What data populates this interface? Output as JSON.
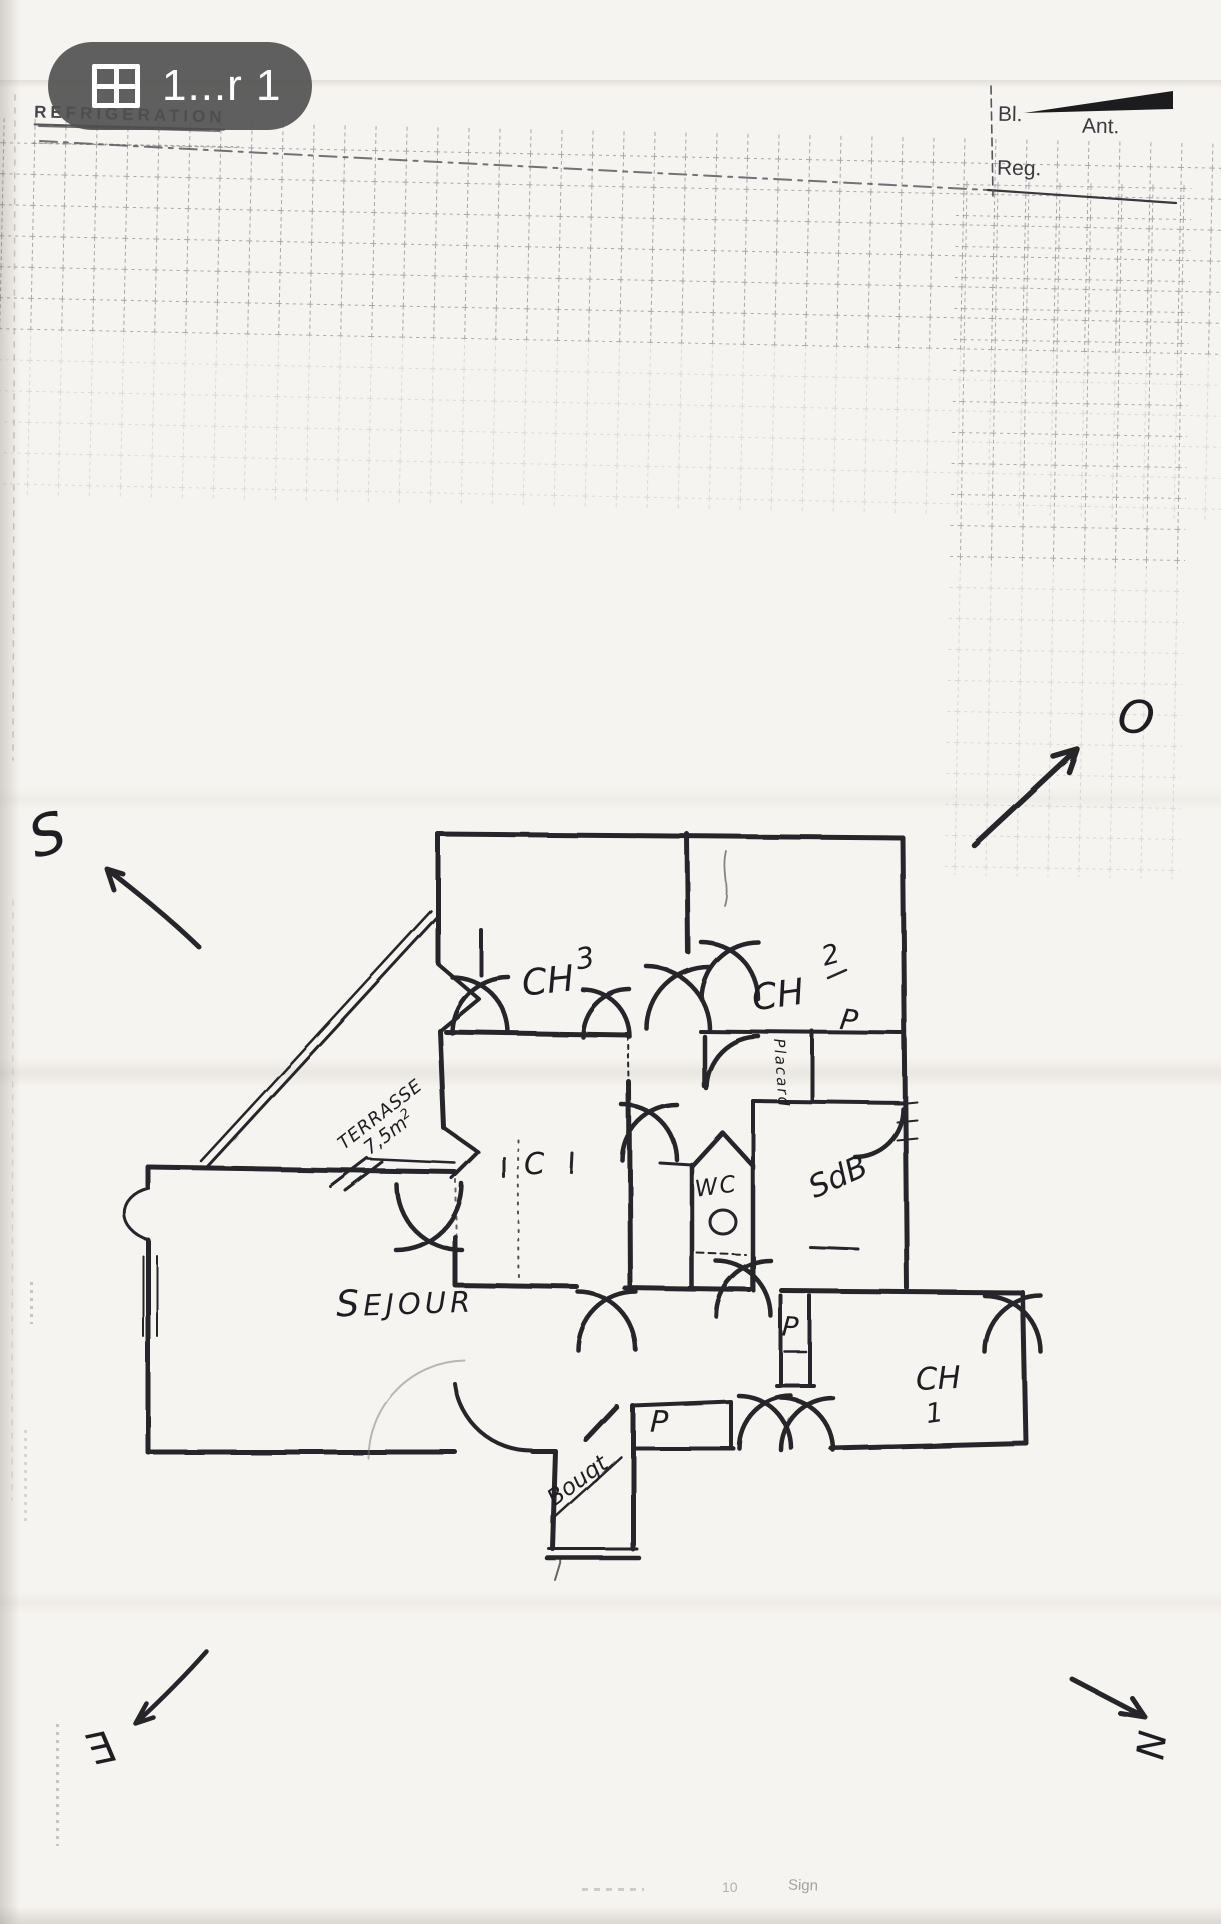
{
  "pill": {
    "label": "1...r 1",
    "icon": "pages-grid-icon"
  },
  "stamp": {
    "title": "REFRIGERATION"
  },
  "header": {
    "bl": "Bl.",
    "ant": "Ant.",
    "reg": "Reg."
  },
  "compass": {
    "south": "S",
    "west": "O",
    "east": "E",
    "north": "N"
  },
  "rooms": {
    "ch3": {
      "name": "CH",
      "num": "3"
    },
    "ch2": {
      "name": "CH",
      "num": "2"
    },
    "ch1": {
      "name": "CH",
      "num": "1"
    },
    "sejour": {
      "name": "SEJOUR"
    },
    "terrasse": {
      "name": "TERRASSE",
      "area": "7,5m",
      "area_sup": "2"
    },
    "wc": {
      "name": "WC"
    },
    "sdb": {
      "name": "SdB"
    },
    "closet": {
      "name": "C"
    },
    "placard": {
      "vertical": "Placard",
      "top": "P",
      "ch1": "P",
      "hall": "P"
    },
    "entry": {
      "name": "Bougt"
    }
  },
  "footer": {
    "mid": "10",
    "right": "Sign"
  },
  "colors": {
    "ink": "#26262b",
    "paper": "#f6f4f0",
    "pill_bg": "#4f4f4f",
    "grid": "#3c3c48"
  }
}
